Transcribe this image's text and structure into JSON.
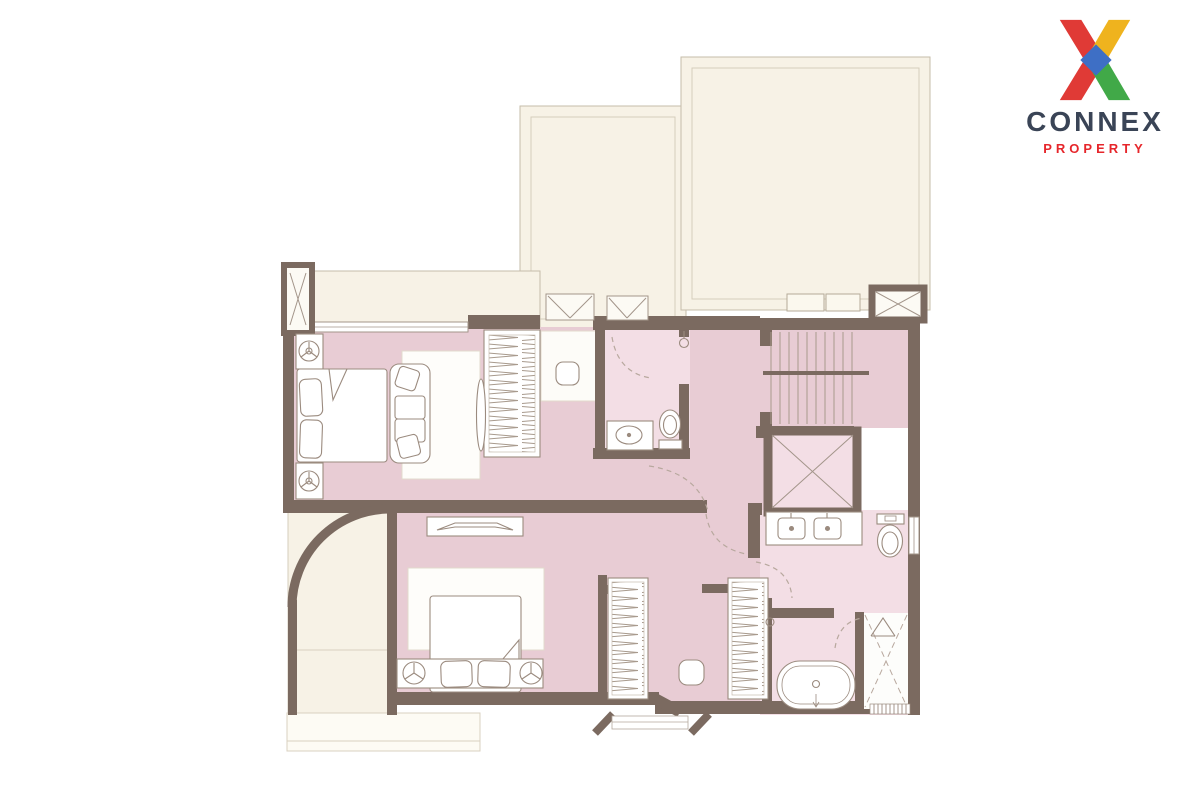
{
  "brand": {
    "name": "CONNEX",
    "tagline": "PROPERTY"
  },
  "palette": {
    "background": "#ffffff",
    "room_pink": "#e8ccd4",
    "bath_pink": "#f3dee5",
    "wall_brown": "#7b6a60",
    "outdoor_cream": "#f7f2e6",
    "cream_border": "#c6bcaa",
    "furniture_line": "#9b8b7f",
    "dash_line": "#b8a89e",
    "logo_red": "#e03a36",
    "logo_yellow": "#efb31e",
    "logo_green": "#41a948",
    "logo_blue": "#3e6fc5",
    "logo_navy": "#3a4456",
    "logo_property_red": "#e6262b"
  },
  "diagram_data": {
    "type": "floor-plan",
    "text_labels": [],
    "rooms": [
      {
        "id": "open-area-right-top",
        "kind": "outdoor-void",
        "fixtures": [
          "planter",
          "planter",
          "ac-shaft-x"
        ]
      },
      {
        "id": "open-area-left-top",
        "kind": "outdoor-void",
        "fixtures": []
      },
      {
        "id": "balcony-strip",
        "kind": "ledge",
        "fixtures": [
          "duct-shaft-x",
          "ac-unit-x",
          "ac-unit-x"
        ]
      },
      {
        "id": "bedroom-upper",
        "kind": "bedroom",
        "fixtures": [
          "double-bed",
          "pillow",
          "pillow",
          "nightstand-lamp",
          "nightstand-lamp",
          "sofa",
          "rug",
          "wardrobe-hangers",
          "mirror",
          "dressing-stool",
          "window"
        ]
      },
      {
        "id": "bathroom-upper",
        "kind": "bathroom",
        "fixtures": [
          "vanity-sink",
          "toilet",
          "door-swing",
          "door-handle"
        ]
      },
      {
        "id": "hallway",
        "kind": "hall",
        "fixtures": [
          "door-swing",
          "door-swing"
        ]
      },
      {
        "id": "staircase",
        "kind": "stairs",
        "fixtures": [
          "treads",
          "handrail"
        ]
      },
      {
        "id": "elevator",
        "kind": "lift-shaft",
        "fixtures": [
          "x-cross"
        ]
      },
      {
        "id": "bedroom-master",
        "kind": "bedroom",
        "fixtures": [
          "double-bed",
          "pillow",
          "pillow",
          "headboard-bench",
          "bedside-lamp",
          "bedside-lamp",
          "tv-console",
          "rug"
        ]
      },
      {
        "id": "walk-in-closet",
        "kind": "closet",
        "fixtures": [
          "wardrobe-hangers",
          "wardrobe-hangers",
          "ottoman",
          "door-handle"
        ]
      },
      {
        "id": "bathroom-master",
        "kind": "bathroom",
        "fixtures": [
          "double-vanity",
          "sink",
          "sink",
          "toilet",
          "bathtub",
          "shower-x",
          "drain-grate",
          "window",
          "door-swing",
          "door-swing"
        ]
      },
      {
        "id": "terrace-curved",
        "kind": "outdoor-terrace",
        "fixtures": [
          "curved-wall",
          "ledge"
        ]
      }
    ]
  }
}
